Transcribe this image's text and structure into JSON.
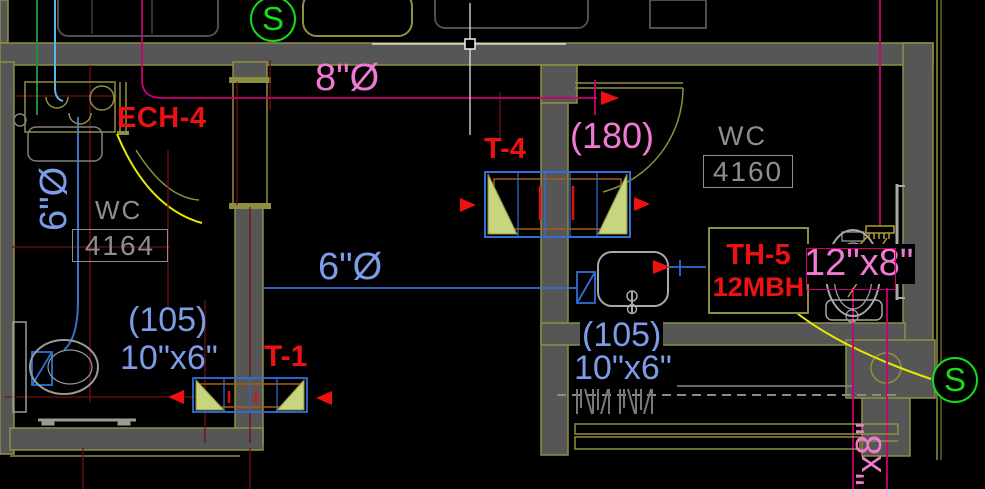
{
  "viewport": {
    "width": 985,
    "height": 489,
    "cursor": "crosshair-pickbox"
  },
  "colors": {
    "background": "#000000",
    "wall_fill": "#565656",
    "wall_edge": "#8f8f42",
    "duct_magenta": "#cc0070",
    "annotation_pink": "#f07ad2",
    "annotation_blue": "#7d9ce8",
    "duct_blue": "#2f6fd8",
    "tag_red": "#ee1111",
    "room_gray": "#8f8f8f",
    "symbol_green": "#17dd17",
    "leader_yellow": "#e8e800",
    "grid_maroon": "#701010",
    "diffuser_fill": "#c7d57e",
    "crosshair_white": "#f0f0f0"
  },
  "symbols": {
    "supply_top": "S",
    "supply_bottom": "S"
  },
  "rooms": {
    "left": {
      "name": "WC",
      "number": "4164"
    },
    "right": {
      "name": "WC",
      "number": "4160"
    }
  },
  "ducts": {
    "round_8": "8\"Ø",
    "round_6_riser": "6\"Ø",
    "round_6_run": "6\"Ø",
    "rect_12x8": "12\"x8\"",
    "rect_10x6_left": "10\"x6\"",
    "rect_10x6_right": "10\"x6\"",
    "rect_8_partial": "\"x8\""
  },
  "equipment": {
    "exhaust_tag": "ECH-4",
    "transfer_grille_t4": "T-4",
    "transfer_grille_t1": "T-1",
    "heater_tag": "TH-5",
    "heater_capacity": "12MBH"
  },
  "airflows": {
    "cfm_180": "(180)",
    "cfm_105_left": "(105)",
    "cfm_105_right": "(105)"
  }
}
